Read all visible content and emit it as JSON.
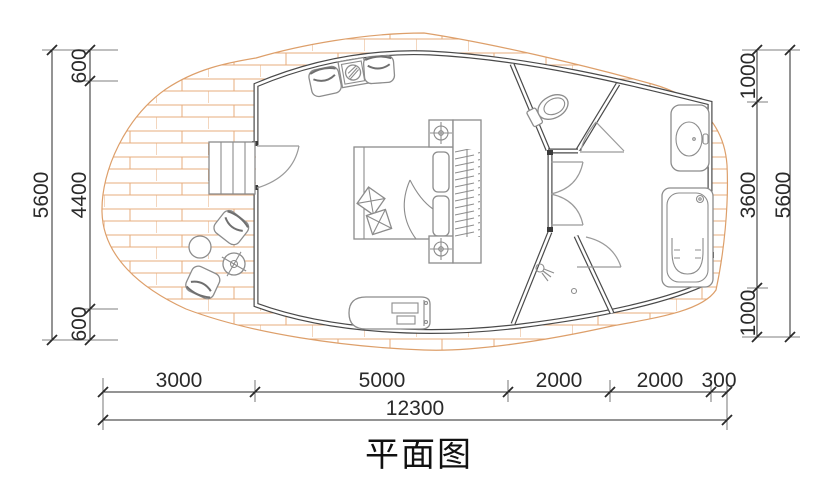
{
  "title": "平面图",
  "dimensions": {
    "left": {
      "total": "5600",
      "segments": [
        "600",
        "4400",
        "600"
      ]
    },
    "right": {
      "total": "5600",
      "segments": [
        "1000",
        "3600",
        "1000"
      ]
    },
    "bottom": {
      "total": "12300",
      "segments": [
        "3000",
        "5000",
        "2000",
        "2000",
        "300"
      ]
    }
  },
  "symbols": [
    "entry-steps",
    "entry-door",
    "lounge-chair",
    "fire-table",
    "double-bed",
    "pillow",
    "cushion",
    "bedside-table",
    "table-lamp",
    "wardrobe",
    "tv-bench",
    "outdoor-chair",
    "outdoor-table",
    "side-table",
    "toilet",
    "shower",
    "washbasin",
    "bathtub",
    "wood-deck"
  ],
  "colors": {
    "background": "#ffffff",
    "deck_line": "#dd9f6a",
    "brick": "#e7ac7c",
    "wall": "#4a4a4a",
    "furniture": "#8c8c8c",
    "dimension": "#2a2a2a"
  }
}
